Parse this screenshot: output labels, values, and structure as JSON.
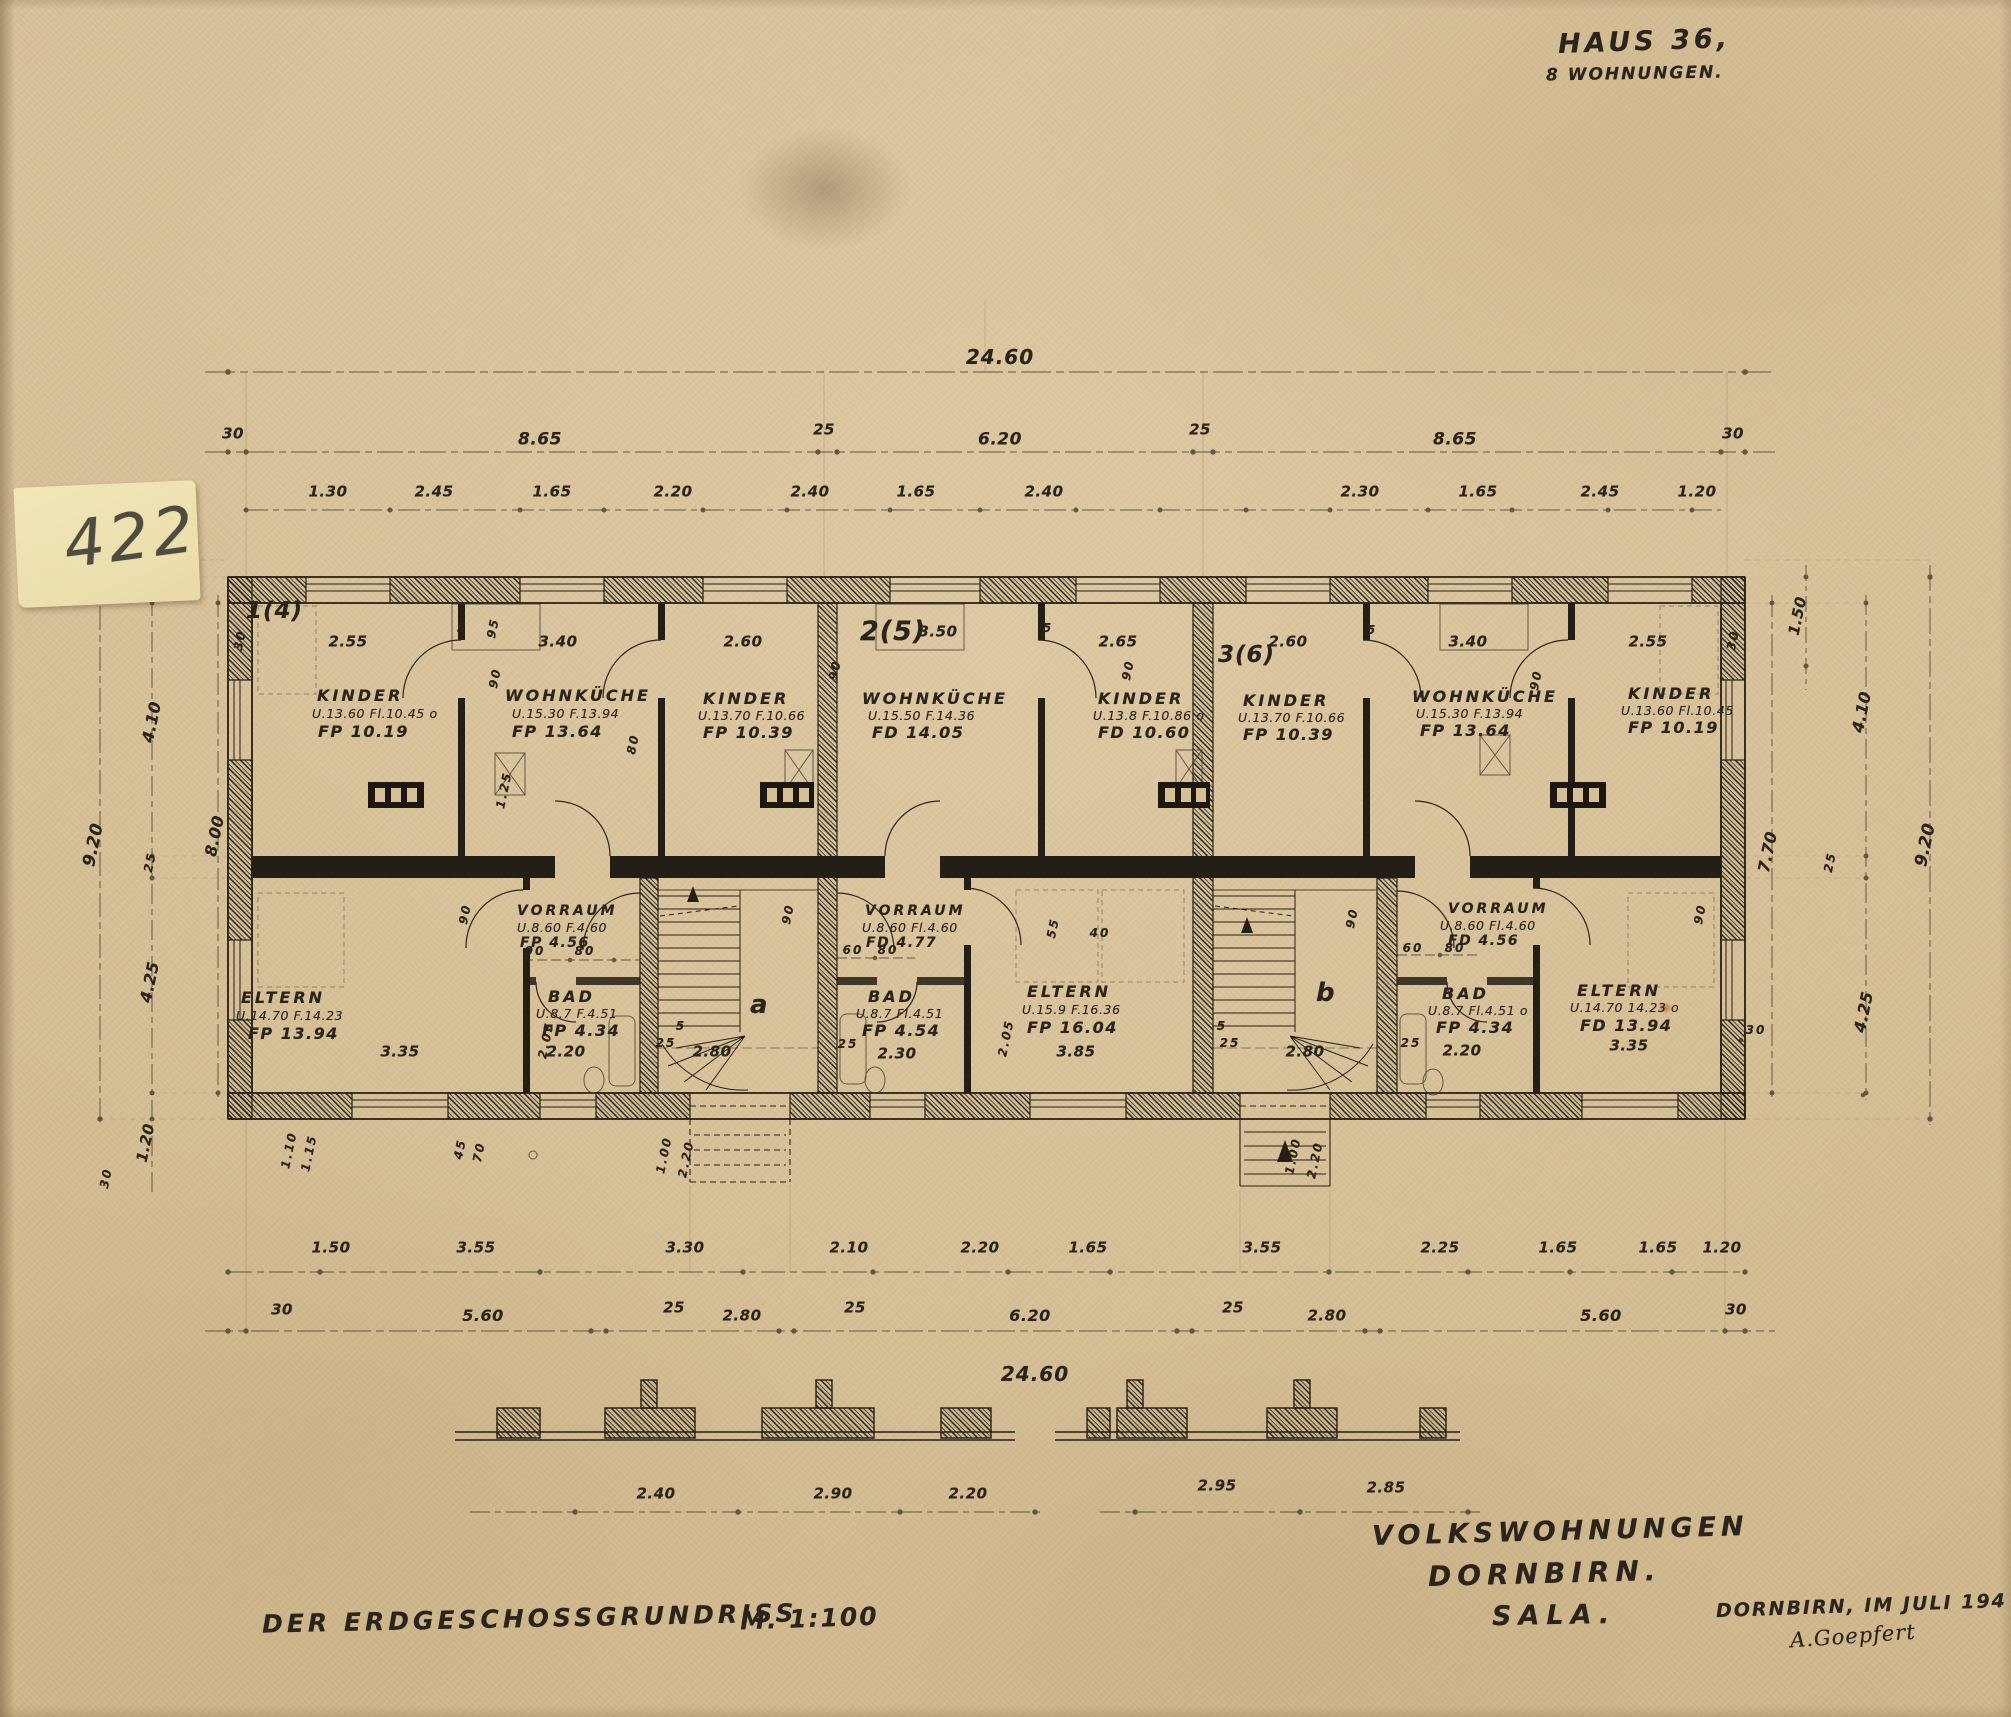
{
  "note": {
    "number": "422"
  },
  "header": {
    "title": "HAUS 36,",
    "subtitle": "8 WOHNUNGEN."
  },
  "footer": {
    "drawing_title": "DER ERDGESCHOSSGRUNDRISS",
    "scale": "M. 1:100",
    "project_line1": "VOLKSWOHNUNGEN",
    "project_line2": "DORNBIRN.",
    "project_line3": "SALA.",
    "place_date": "DORNBIRN, IM JULI 194",
    "signature": "A.Goepfert"
  },
  "apartments": {
    "a1": "1(4)",
    "a2": "2(5)",
    "a3": "3(6)"
  },
  "stairwells": {
    "a": "a",
    "b": "b"
  },
  "rooms": {
    "kinder1": {
      "name": "KINDER",
      "area": "U.13.60 Fl.10.45 o",
      "fp": "FP 10.19"
    },
    "wohnkueche1": {
      "name": "WOHNKÜCHE",
      "area": "U.15.30 F.13.94",
      "fp": "FP 13.64"
    },
    "kinder2": {
      "name": "KINDER",
      "area": "U.13.70 F.10.66",
      "fp": "FP 10.39"
    },
    "wohnkueche2": {
      "name": "WOHNKÜCHE",
      "area": "U.15.50 F.14.36",
      "fp": "FD 14.05"
    },
    "kinder3": {
      "name": "KINDER",
      "area": "U.13.8 F.10.86 o",
      "fp": "FD 10.60"
    },
    "kinder4": {
      "name": "KINDER",
      "area": "U.13.70 F.10.66",
      "fp": "FP 10.39"
    },
    "wohnkueche3": {
      "name": "WOHNKÜCHE",
      "area": "U.15.30 F.13.94",
      "fp": "FP 13.64"
    },
    "kinder5": {
      "name": "KINDER",
      "area": "U.13.60 Fl.10.45",
      "fp": "FP 10.19"
    },
    "vorraum1": {
      "name": "VORRAUM",
      "area": "U.8.60 F.4.60",
      "fp": "FP 4.56"
    },
    "bad1": {
      "name": "BAD",
      "area": "U.8.7 F.4.51",
      "fp": "FP 4.34"
    },
    "eltern1": {
      "name": "ELTERN",
      "area": "U.14.70 F.14.23",
      "fp": "FP 13.94"
    },
    "vorraum2": {
      "name": "VORRAUM",
      "area": "U.8.60 Fl.4.60",
      "fp": "FD 4.77"
    },
    "bad2": {
      "name": "BAD",
      "area": "U.8.7 Fl.4.51",
      "fp": "FP 4.54"
    },
    "eltern2": {
      "name": "ELTERN",
      "area": "U.15.9 F.16.36",
      "fp": "FP 16.04"
    },
    "vorraum3": {
      "name": "VORRAUM",
      "area": "U.8.60 Fl.4.60",
      "fp": "FD 4.56"
    },
    "bad3": {
      "name": "BAD",
      "area": "U.8.7 Fl.4.51 o",
      "fp": "FP 4.34"
    },
    "eltern3": {
      "name": "ELTERN",
      "area": "U.14.70 14.23 o",
      "fp": "FD 13.94"
    }
  },
  "dims": {
    "top_total": "24.60",
    "bottom_total": "24.60",
    "row2": [
      "30",
      "8.65",
      "25",
      "6.20",
      "25",
      "8.65",
      "30"
    ],
    "row3": [
      "1.30",
      "2.45",
      "1.65",
      "2.20",
      "2.40",
      "1.65",
      "2.40",
      "2.30",
      "1.65",
      "2.45",
      "1.20"
    ],
    "widths_top": [
      "2.55",
      "3.40",
      "2.60",
      "3.50",
      "2.65",
      "2.60",
      "3.40",
      "2.55"
    ],
    "widths_bottom": [
      "3.35",
      "2.20",
      "2.80",
      "2.30",
      "3.85",
      "2.80",
      "2.20",
      "3.35"
    ],
    "row_a": [
      "1.50",
      "3.55",
      "3.30",
      "2.10",
      "2.20",
      "1.65",
      "3.55",
      "2.25",
      "1.65",
      "1.65",
      "1.20"
    ],
    "row_b": [
      "30",
      "5.60",
      "25",
      "2.80",
      "25",
      "6.20",
      "25",
      "2.80",
      "5.60",
      "30"
    ],
    "profile": [
      "2.40",
      "2.90",
      "2.20",
      "2.95",
      "2.85"
    ],
    "left": {
      "w410": "4.10",
      "w25": "25",
      "w800": "8.00",
      "w920": "9.20",
      "w425": "4.25",
      "w120": "1.20",
      "w30": "30"
    },
    "right": {
      "w150": "1.50",
      "w410": "4.10",
      "w770": "7.70",
      "w920": "9.20",
      "w425": "4.25",
      "w25": "25",
      "w30": "30"
    },
    "small": {
      "w90": "90",
      "w80": "80",
      "w60": "60",
      "w55": "55",
      "w40": "40",
      "w25": "25",
      "w5": "5",
      "w95": "95",
      "w125": "1.25",
      "w205": "2.05",
      "w100": "1.00",
      "w220": "2.20",
      "w110": "1.10",
      "w115": "1.15",
      "w45": "45",
      "w70": "70",
      "w30": "30"
    }
  }
}
